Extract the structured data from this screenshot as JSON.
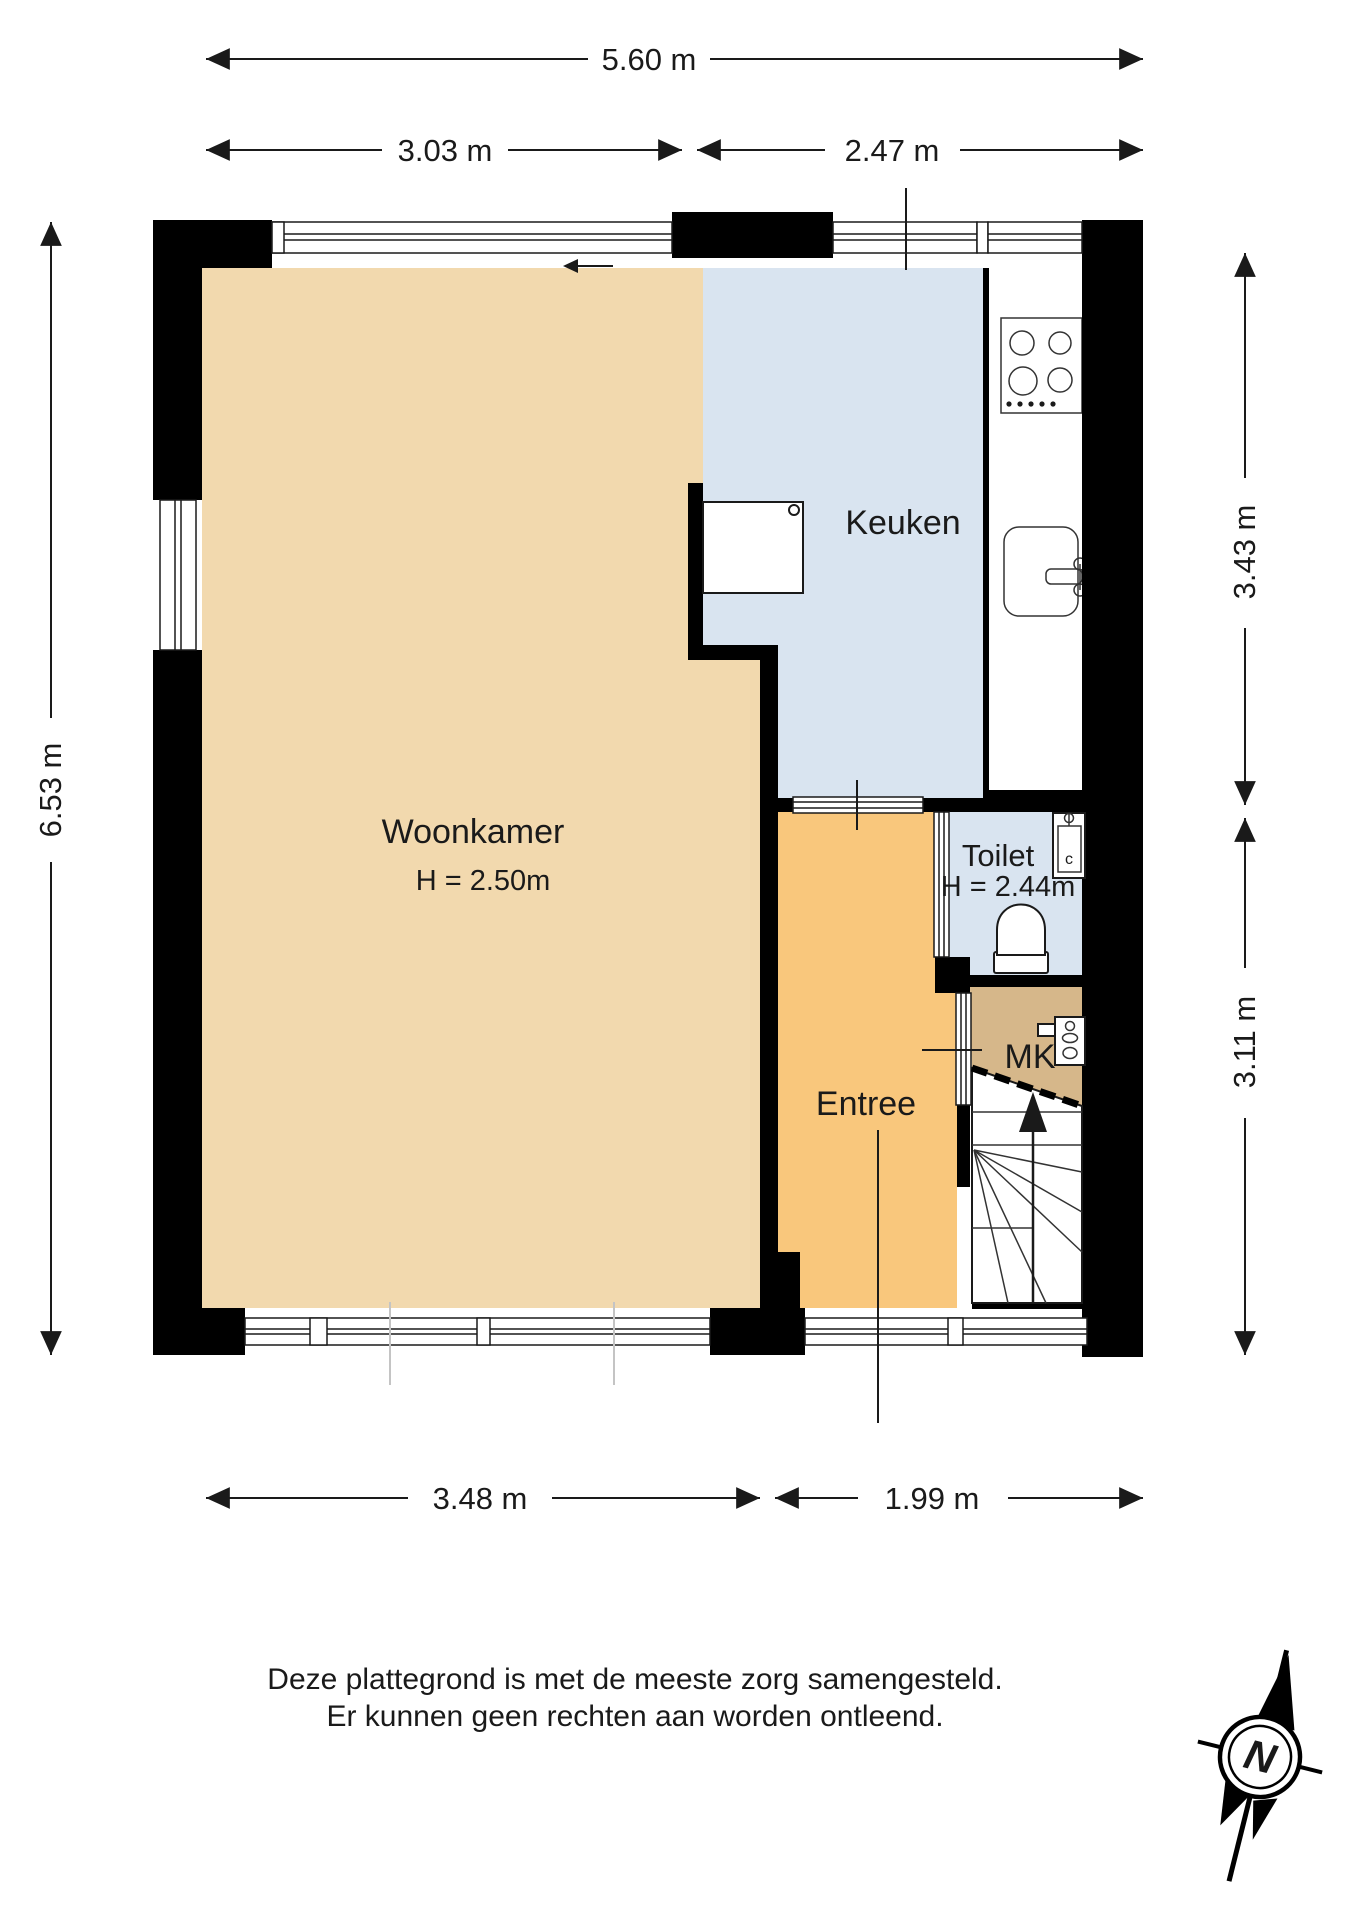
{
  "floorplan": {
    "rooms": {
      "woonkamer": {
        "label": "Woonkamer",
        "height": "H = 2.50m"
      },
      "keuken": {
        "label": "Keuken"
      },
      "toilet": {
        "label": "Toilet",
        "height": "H = 2.44m"
      },
      "entree": {
        "label": "Entree"
      },
      "mk": {
        "label": "MK"
      }
    },
    "dimensions": {
      "top_total": "5.60 m",
      "top_left": "3.03 m",
      "top_right": "2.47 m",
      "left": "6.53 m",
      "right_top": "3.43 m",
      "right_bottom": "3.11 m",
      "bottom_left": "3.48 m",
      "bottom_right": "1.99 m"
    },
    "fixtures": {
      "sink_tap_label": "c"
    },
    "compass": {
      "north": "N"
    },
    "disclaimer": {
      "line1": "Deze plattegrond is met de meeste zorg samengesteld.",
      "line2": "Er kunnen geen rechten aan worden ontleend."
    },
    "colors": {
      "woonkamer": "#f2d9ae",
      "keuken": "#d9e4f0",
      "toilet": "#d9e4f0",
      "entree": "#f9c77c",
      "mk": "#d6b78a",
      "wall": "#000000"
    }
  }
}
